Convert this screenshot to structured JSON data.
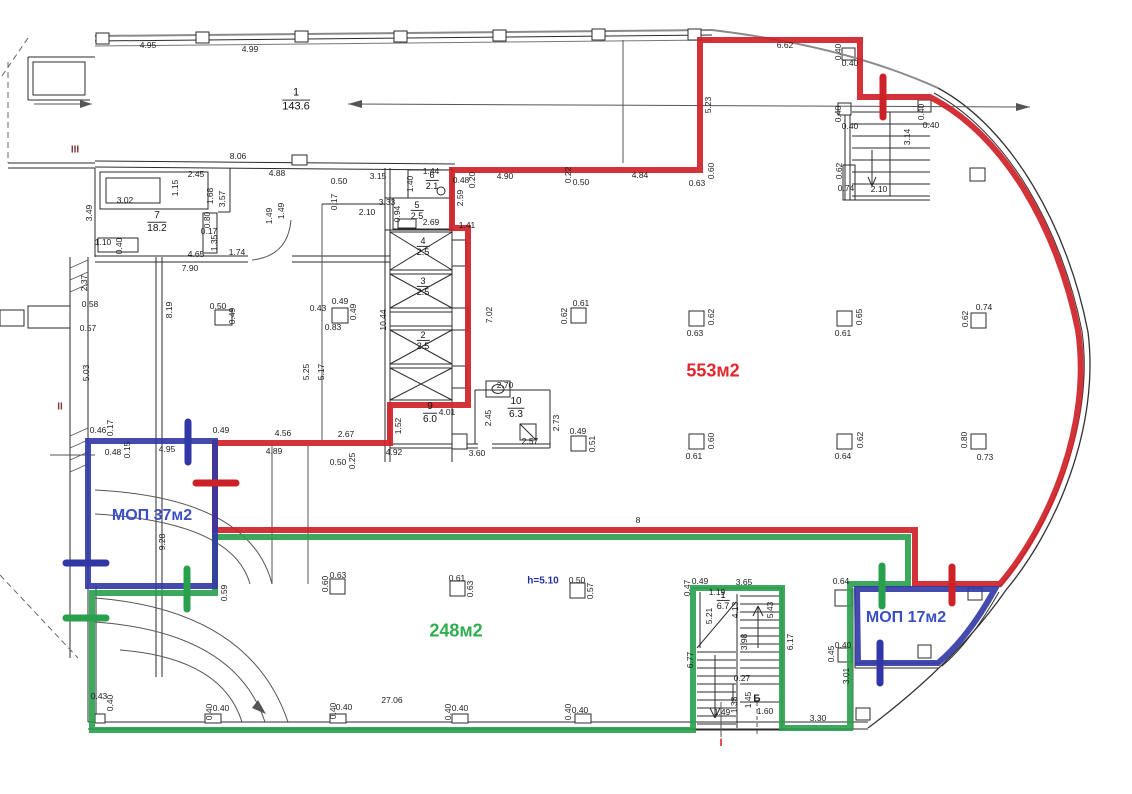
{
  "title": "Floor plan with colored lease areas",
  "colors": {
    "outline_red": "#ce2127",
    "outline_green": "#28a04c",
    "outline_blue": "#3137a5",
    "label_red": "#e2262b",
    "label_green": "#2fae51",
    "label_blue": "#3a50c2",
    "label_navy": "#22309b",
    "marker_dark_red": "#7e3a3a",
    "ink": "#1c1c1c"
  },
  "areas": [
    {
      "text": "553м2",
      "x": 713,
      "y": 371,
      "color": "label_red",
      "size": 18
    },
    {
      "text": "МОП 37м2",
      "x": 152,
      "y": 516,
      "color": "label_blue",
      "size": 16
    },
    {
      "text": "248м2",
      "x": 456,
      "y": 631,
      "color": "label_green",
      "size": 18
    },
    {
      "text": "МОП 17м2",
      "x": 906,
      "y": 618,
      "color": "label_blue",
      "size": 16
    },
    {
      "text": "h=5.10",
      "x": 543,
      "y": 581,
      "color": "label_navy",
      "size": 10
    }
  ],
  "markers": [
    {
      "text": "III",
      "x": 75,
      "y": 150,
      "color": "marker_dark_red",
      "size": 10
    },
    {
      "text": "II",
      "x": 60,
      "y": 407,
      "color": "marker_dark_red",
      "size": 10
    },
    {
      "text": "I",
      "x": 721,
      "y": 743,
      "color": "label_red",
      "size": 11
    },
    {
      "text": "Б",
      "x": 757,
      "y": 699,
      "color": "ink",
      "size": 10
    }
  ],
  "rooms": [
    {
      "num": "1",
      "area": "143.6",
      "x": 296,
      "y": 100,
      "size": 11
    },
    {
      "num": "7",
      "area": "18.2",
      "x": 157,
      "y": 222,
      "size": 10
    },
    {
      "num": "6",
      "area": "2.1",
      "x": 432,
      "y": 181,
      "size": 9
    },
    {
      "num": "5",
      "area": "2.5",
      "x": 417,
      "y": 211,
      "size": 9
    },
    {
      "num": "4",
      "area": "2.5",
      "x": 423,
      "y": 247,
      "size": 9
    },
    {
      "num": "3",
      "area": "2.5",
      "x": 423,
      "y": 287,
      "size": 9
    },
    {
      "num": "2",
      "area": "2.5",
      "x": 423,
      "y": 341,
      "size": 9
    },
    {
      "num": "9",
      "area": "6.0",
      "x": 430,
      "y": 413,
      "size": 10
    },
    {
      "num": "10",
      "area": "6.3",
      "x": 516,
      "y": 408,
      "size": 10
    },
    {
      "num": "1",
      "area": "6.7",
      "x": 723,
      "y": 601,
      "size": 9
    }
  ],
  "dims": [
    {
      "t": "4.95",
      "x": 148,
      "y": 45
    },
    {
      "t": "4.99",
      "x": 250,
      "y": 49
    },
    {
      "t": "6.62",
      "x": 785,
      "y": 45
    },
    {
      "t": "5.23",
      "x": 708,
      "y": 105,
      "r": 1
    },
    {
      "t": "0.40",
      "x": 838,
      "y": 52,
      "r": 1
    },
    {
      "t": "0.40",
      "x": 850,
      "y": 63
    },
    {
      "t": "0.40",
      "x": 838,
      "y": 114,
      "r": 1
    },
    {
      "t": "0.40",
      "x": 850,
      "y": 126
    },
    {
      "t": "0.40",
      "x": 921,
      "y": 112,
      "r": 1
    },
    {
      "t": "0.40",
      "x": 931,
      "y": 125
    },
    {
      "t": "3.14",
      "x": 907,
      "y": 137,
      "r": 1
    },
    {
      "t": "0.62",
      "x": 839,
      "y": 171,
      "r": 1
    },
    {
      "t": "0.74",
      "x": 846,
      "y": 188
    },
    {
      "t": "2.10",
      "x": 879,
      "y": 189
    },
    {
      "t": "8.06",
      "x": 238,
      "y": 156
    },
    {
      "t": "2.45",
      "x": 196,
      "y": 174
    },
    {
      "t": "4.88",
      "x": 277,
      "y": 173
    },
    {
      "t": "1.15",
      "x": 175,
      "y": 188,
      "r": 1
    },
    {
      "t": "3.02",
      "x": 125,
      "y": 200
    },
    {
      "t": "3.49",
      "x": 89,
      "y": 213,
      "r": 1
    },
    {
      "t": "1.10",
      "x": 103,
      "y": 242
    },
    {
      "t": "0.40",
      "x": 119,
      "y": 246,
      "r": 1
    },
    {
      "t": "4.65",
      "x": 196,
      "y": 254
    },
    {
      "t": "1.74",
      "x": 237,
      "y": 252
    },
    {
      "t": "7.90",
      "x": 190,
      "y": 268
    },
    {
      "t": "1.68",
      "x": 210,
      "y": 196,
      "r": 1
    },
    {
      "t": "3.57",
      "x": 222,
      "y": 199,
      "r": 1
    },
    {
      "t": "0.80",
      "x": 207,
      "y": 220,
      "r": 1
    },
    {
      "t": "0.17",
      "x": 209,
      "y": 231
    },
    {
      "t": "1.35",
      "x": 214,
      "y": 243,
      "r": 1
    },
    {
      "t": "1.49",
      "x": 269,
      "y": 216,
      "r": 1
    },
    {
      "t": "1.49",
      "x": 281,
      "y": 211,
      "r": 1
    },
    {
      "t": "0.50",
      "x": 339,
      "y": 181
    },
    {
      "t": "3.15",
      "x": 378,
      "y": 176
    },
    {
      "t": "1.40",
      "x": 410,
      "y": 184,
      "r": 1
    },
    {
      "t": "1.44",
      "x": 431,
      "y": 171
    },
    {
      "t": "0.48",
      "x": 461,
      "y": 180
    },
    {
      "t": "0.20",
      "x": 472,
      "y": 180,
      "r": 1
    },
    {
      "t": "0.17",
      "x": 334,
      "y": 202,
      "r": 1
    },
    {
      "t": "3.33",
      "x": 387,
      "y": 202
    },
    {
      "t": "2.10",
      "x": 367,
      "y": 212
    },
    {
      "t": "0.94",
      "x": 397,
      "y": 214,
      "r": 1
    },
    {
      "t": "2.69",
      "x": 431,
      "y": 222
    },
    {
      "t": "2.59",
      "x": 460,
      "y": 198,
      "r": 1
    },
    {
      "t": "1.41",
      "x": 467,
      "y": 225
    },
    {
      "t": "2.37",
      "x": 84,
      "y": 283,
      "r": 1
    },
    {
      "t": "0.58",
      "x": 90,
      "y": 304
    },
    {
      "t": "0.57",
      "x": 88,
      "y": 328
    },
    {
      "t": "5.03",
      "x": 86,
      "y": 373,
      "r": 1
    },
    {
      "t": "8.19",
      "x": 169,
      "y": 310,
      "r": 1
    },
    {
      "t": "0.50",
      "x": 218,
      "y": 306
    },
    {
      "t": "0.49",
      "x": 232,
      "y": 316,
      "r": 1
    },
    {
      "t": "4.90",
      "x": 505,
      "y": 176
    },
    {
      "t": "0.22",
      "x": 568,
      "y": 175,
      "r": 1
    },
    {
      "t": "0.50",
      "x": 581,
      "y": 182
    },
    {
      "t": "4.84",
      "x": 640,
      "y": 175
    },
    {
      "t": "0.63",
      "x": 697,
      "y": 183
    },
    {
      "t": "0.60",
      "x": 711,
      "y": 171,
      "r": 1
    },
    {
      "t": "7.02",
      "x": 489,
      "y": 315,
      "r": 1
    },
    {
      "t": "10.44",
      "x": 383,
      "y": 320,
      "r": 1
    },
    {
      "t": "5.25",
      "x": 306,
      "y": 372,
      "r": 1
    },
    {
      "t": "5.17",
      "x": 321,
      "y": 372,
      "r": 1
    },
    {
      "t": "0.49",
      "x": 340,
      "y": 301
    },
    {
      "t": "0.43",
      "x": 318,
      "y": 308
    },
    {
      "t": "0.49",
      "x": 353,
      "y": 312,
      "r": 1
    },
    {
      "t": "0.83",
      "x": 333,
      "y": 327
    },
    {
      "t": "4.01",
      "x": 447,
      "y": 412
    },
    {
      "t": "2.70",
      "x": 505,
      "y": 385
    },
    {
      "t": "2.45",
      "x": 488,
      "y": 418,
      "r": 1
    },
    {
      "t": "2.57",
      "x": 530,
      "y": 441
    },
    {
      "t": "3.60",
      "x": 477,
      "y": 453
    },
    {
      "t": "2.73",
      "x": 556,
      "y": 423,
      "r": 1
    },
    {
      "t": "1.52",
      "x": 398,
      "y": 426,
      "r": 1
    },
    {
      "t": "4.92",
      "x": 394,
      "y": 452
    },
    {
      "t": "2.67",
      "x": 346,
      "y": 434
    },
    {
      "t": "0.50",
      "x": 338,
      "y": 462
    },
    {
      "t": "0.25",
      "x": 352,
      "y": 461,
      "r": 1
    },
    {
      "t": "0.61",
      "x": 581,
      "y": 303
    },
    {
      "t": "0.62",
      "x": 564,
      "y": 316,
      "r": 1
    },
    {
      "t": "0.62",
      "x": 711,
      "y": 317,
      "r": 1
    },
    {
      "t": "0.63",
      "x": 695,
      "y": 333
    },
    {
      "t": "0.65",
      "x": 859,
      "y": 317,
      "r": 1
    },
    {
      "t": "0.61",
      "x": 843,
      "y": 333
    },
    {
      "t": "0.74",
      "x": 984,
      "y": 307
    },
    {
      "t": "0.62",
      "x": 965,
      "y": 319,
      "r": 1
    },
    {
      "t": "0.49",
      "x": 578,
      "y": 431
    },
    {
      "t": "0.51",
      "x": 592,
      "y": 444,
      "r": 1
    },
    {
      "t": "0.60",
      "x": 711,
      "y": 441,
      "r": 1
    },
    {
      "t": "0.61",
      "x": 694,
      "y": 456
    },
    {
      "t": "0.62",
      "x": 860,
      "y": 440,
      "r": 1
    },
    {
      "t": "0.64",
      "x": 843,
      "y": 456
    },
    {
      "t": "0.80",
      "x": 964,
      "y": 440,
      "r": 1
    },
    {
      "t": "0.73",
      "x": 985,
      "y": 457
    },
    {
      "t": "8",
      "x": 638,
      "y": 520
    },
    {
      "t": "0.46",
      "x": 98,
      "y": 430
    },
    {
      "t": "0.17",
      "x": 110,
      "y": 428,
      "r": 1
    },
    {
      "t": "0.48",
      "x": 113,
      "y": 452
    },
    {
      "t": "0.15",
      "x": 127,
      "y": 450,
      "r": 1
    },
    {
      "t": "4.95",
      "x": 167,
      "y": 449
    },
    {
      "t": "0.49",
      "x": 221,
      "y": 430
    },
    {
      "t": "4.56",
      "x": 283,
      "y": 433
    },
    {
      "t": "4.89",
      "x": 274,
      "y": 451
    },
    {
      "t": "9.28",
      "x": 162,
      "y": 542,
      "r": 1
    },
    {
      "t": "0.59",
      "x": 224,
      "y": 593,
      "r": 1
    },
    {
      "t": "0.63",
      "x": 338,
      "y": 575
    },
    {
      "t": "0.60",
      "x": 325,
      "y": 584,
      "r": 1
    },
    {
      "t": "0.61",
      "x": 457,
      "y": 578
    },
    {
      "t": "0.63",
      "x": 470,
      "y": 589,
      "r": 1
    },
    {
      "t": "0.50",
      "x": 577,
      "y": 580
    },
    {
      "t": "0.57",
      "x": 590,
      "y": 591,
      "r": 1
    },
    {
      "t": "0.47",
      "x": 687,
      "y": 588,
      "r": 1
    },
    {
      "t": "0.49",
      "x": 700,
      "y": 581
    },
    {
      "t": "3.65",
      "x": 744,
      "y": 582
    },
    {
      "t": "1.19",
      "x": 717,
      "y": 592
    },
    {
      "t": "4.13",
      "x": 735,
      "y": 610,
      "r": 1
    },
    {
      "t": "5.21",
      "x": 709,
      "y": 616,
      "r": 1
    },
    {
      "t": "5.43",
      "x": 770,
      "y": 610,
      "r": 1
    },
    {
      "t": "3.98",
      "x": 744,
      "y": 642,
      "r": 1
    },
    {
      "t": "6.77",
      "x": 690,
      "y": 660,
      "r": 1
    },
    {
      "t": "6.17",
      "x": 790,
      "y": 642,
      "r": 1
    },
    {
      "t": "0.27",
      "x": 742,
      "y": 678
    },
    {
      "t": "1.45",
      "x": 748,
      "y": 700,
      "r": 1
    },
    {
      "t": "1.33",
      "x": 734,
      "y": 705,
      "r": 1
    },
    {
      "t": "1.49",
      "x": 722,
      "y": 712
    },
    {
      "t": "1.60",
      "x": 765,
      "y": 711
    },
    {
      "t": "0.64",
      "x": 841,
      "y": 581
    },
    {
      "t": "0.40",
      "x": 843,
      "y": 645
    },
    {
      "t": "0.45",
      "x": 831,
      "y": 654,
      "r": 1
    },
    {
      "t": "3.01",
      "x": 846,
      "y": 676,
      "r": 1
    },
    {
      "t": "3.30",
      "x": 818,
      "y": 718
    },
    {
      "t": "0.43",
      "x": 99,
      "y": 696
    },
    {
      "t": "0.40",
      "x": 110,
      "y": 703,
      "r": 1
    },
    {
      "t": "0.40",
      "x": 209,
      "y": 712,
      "r": 1
    },
    {
      "t": "0.40",
      "x": 221,
      "y": 708
    },
    {
      "t": "0.40",
      "x": 333,
      "y": 711,
      "r": 1
    },
    {
      "t": "0.40",
      "x": 344,
      "y": 707
    },
    {
      "t": "27.06",
      "x": 392,
      "y": 700
    },
    {
      "t": "0.40",
      "x": 448,
      "y": 712,
      "r": 1
    },
    {
      "t": "0.40",
      "x": 460,
      "y": 708
    },
    {
      "t": "0.40",
      "x": 568,
      "y": 712,
      "r": 1
    },
    {
      "t": "0.40",
      "x": 580,
      "y": 710
    }
  ]
}
